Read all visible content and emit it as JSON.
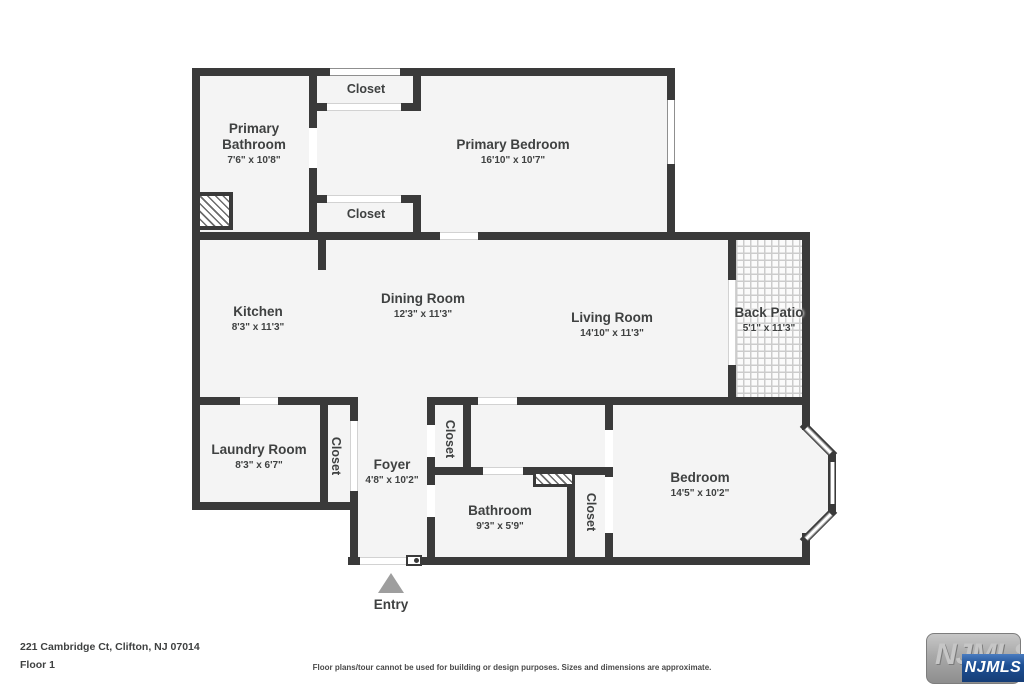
{
  "floor_plan": {
    "rooms": [
      {
        "name": "Primary Bathroom",
        "dims": "7'6\" x 10'8\""
      },
      {
        "name": "Primary Bedroom",
        "dims": "16'10\" x 10'7\""
      },
      {
        "name": "Kitchen",
        "dims": "8'3\" x 11'3\""
      },
      {
        "name": "Dining Room",
        "dims": "12'3\" x 11'3\""
      },
      {
        "name": "Living Room",
        "dims": "14'10\" x 11'3\""
      },
      {
        "name": "Back Patio",
        "dims": "5'1\" x 11'3\""
      },
      {
        "name": "Laundry Room",
        "dims": "8'3\" x 6'7\""
      },
      {
        "name": "Foyer",
        "dims": "4'8\" x 10'2\""
      },
      {
        "name": "Bathroom",
        "dims": "9'3\" x 5'9\""
      },
      {
        "name": "Bedroom",
        "dims": "14'5\" x 10'2\""
      }
    ],
    "closets": {
      "top": "Closet",
      "middle": "Closet",
      "laundry": "Closet",
      "foyer": "Closet",
      "bedroom": "Closet"
    },
    "entry_label": "Entry"
  },
  "footer": {
    "address": "221 Cambridge Ct, Clifton, NJ 07014",
    "floor": "Floor 1",
    "disclaimer": "Floor plans/tour cannot be used for building or design purposes. Sizes and dimensions are approximate."
  },
  "logo": {
    "watermark": "NJMLS",
    "badge": "NJMLS"
  },
  "colors": {
    "wall": "#3a3a3a",
    "floor": "#f4f4f4",
    "text": "#3f4141",
    "entry_arrow": "#9e9e9e",
    "badge_blue": "#1d4f94"
  }
}
